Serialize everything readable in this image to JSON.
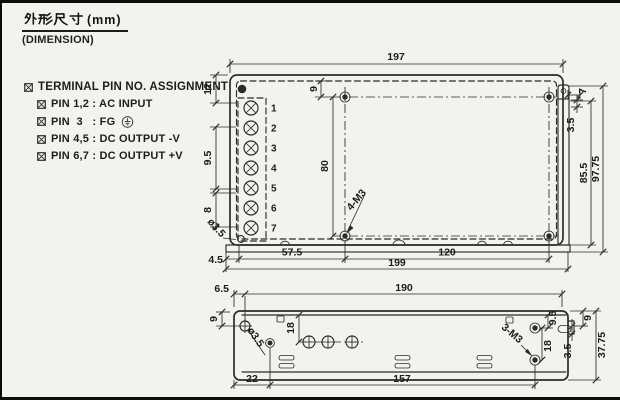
{
  "title": {
    "zh": "外形尺寸",
    "suffix": "(mm)",
    "subtitle": "(DIMENSION)"
  },
  "notes": {
    "heading": "TERMINAL PIN NO. ASSIGNMENT",
    "items": [
      "PIN 1,2 : AC INPUT",
      "PIN  3   : FG",
      "PIN 4,5 : DC OUTPUT -V",
      "PIN 6,7 : DC OUTPUT +V"
    ]
  },
  "top_view": {
    "pins": [
      "1",
      "2",
      "3",
      "4",
      "5",
      "6",
      "7"
    ],
    "dims": {
      "width_top": "197",
      "pin_top_offset": "12",
      "pin_pitch": "9.5",
      "pin_pitch_lower": "8",
      "corner_hole_dia": "ø3.5",
      "hole_top_offset": "9",
      "hole_vertical_span": "80",
      "mounting_holes": "4-M3",
      "bracket_width": "7",
      "bracket_offset": "3.5",
      "body_height": "85.5",
      "overall_height": "97.75",
      "base_left_offset": "4.5",
      "hole_x_offset": "57.5",
      "hole_x_span": "120",
      "overall_width": "199"
    }
  },
  "bottom_view": {
    "dims": {
      "left_offset": "6.5",
      "top_width": "190",
      "hole_top_offset": "9",
      "vent_offset": "18",
      "hole_dia": "ø3.5",
      "bottom_left_offset": "22",
      "bottom_span": "157",
      "side_holes": "3-M3",
      "side_hole_span": "18",
      "side_hole_top_offset": "9.5",
      "slot_offset": "3.5",
      "right_top_offset": "9",
      "overall_height": "37.75"
    }
  }
}
